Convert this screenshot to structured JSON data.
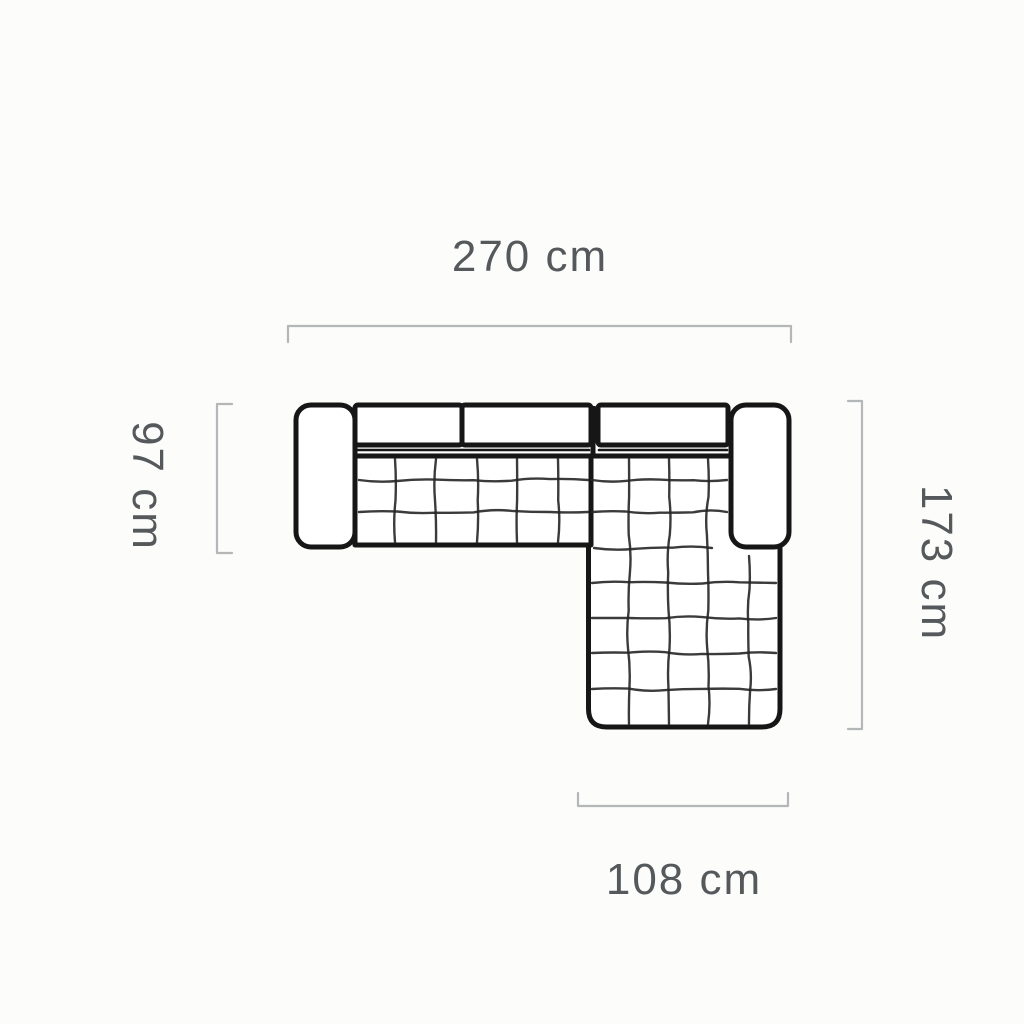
{
  "diagram": {
    "name": "corner-sofa-top-view-dimension-diagram",
    "unit": "cm",
    "dimensions": {
      "total_width": {
        "value": 270,
        "label": "270 cm",
        "side": "top"
      },
      "sofa_depth": {
        "value": 97,
        "label": "97 cm",
        "side": "left"
      },
      "total_depth": {
        "value": 173,
        "label": "173 cm",
        "side": "right"
      },
      "chaise_width": {
        "value": 108,
        "label": "108 cm",
        "side": "bottom"
      }
    },
    "colors": {
      "background": "#fcfcfb",
      "fill": "#ffffff",
      "outline": "#161616",
      "quilt_line": "#262626",
      "dimension_line": "#b4b7b8",
      "label_text": "#55595b"
    }
  }
}
